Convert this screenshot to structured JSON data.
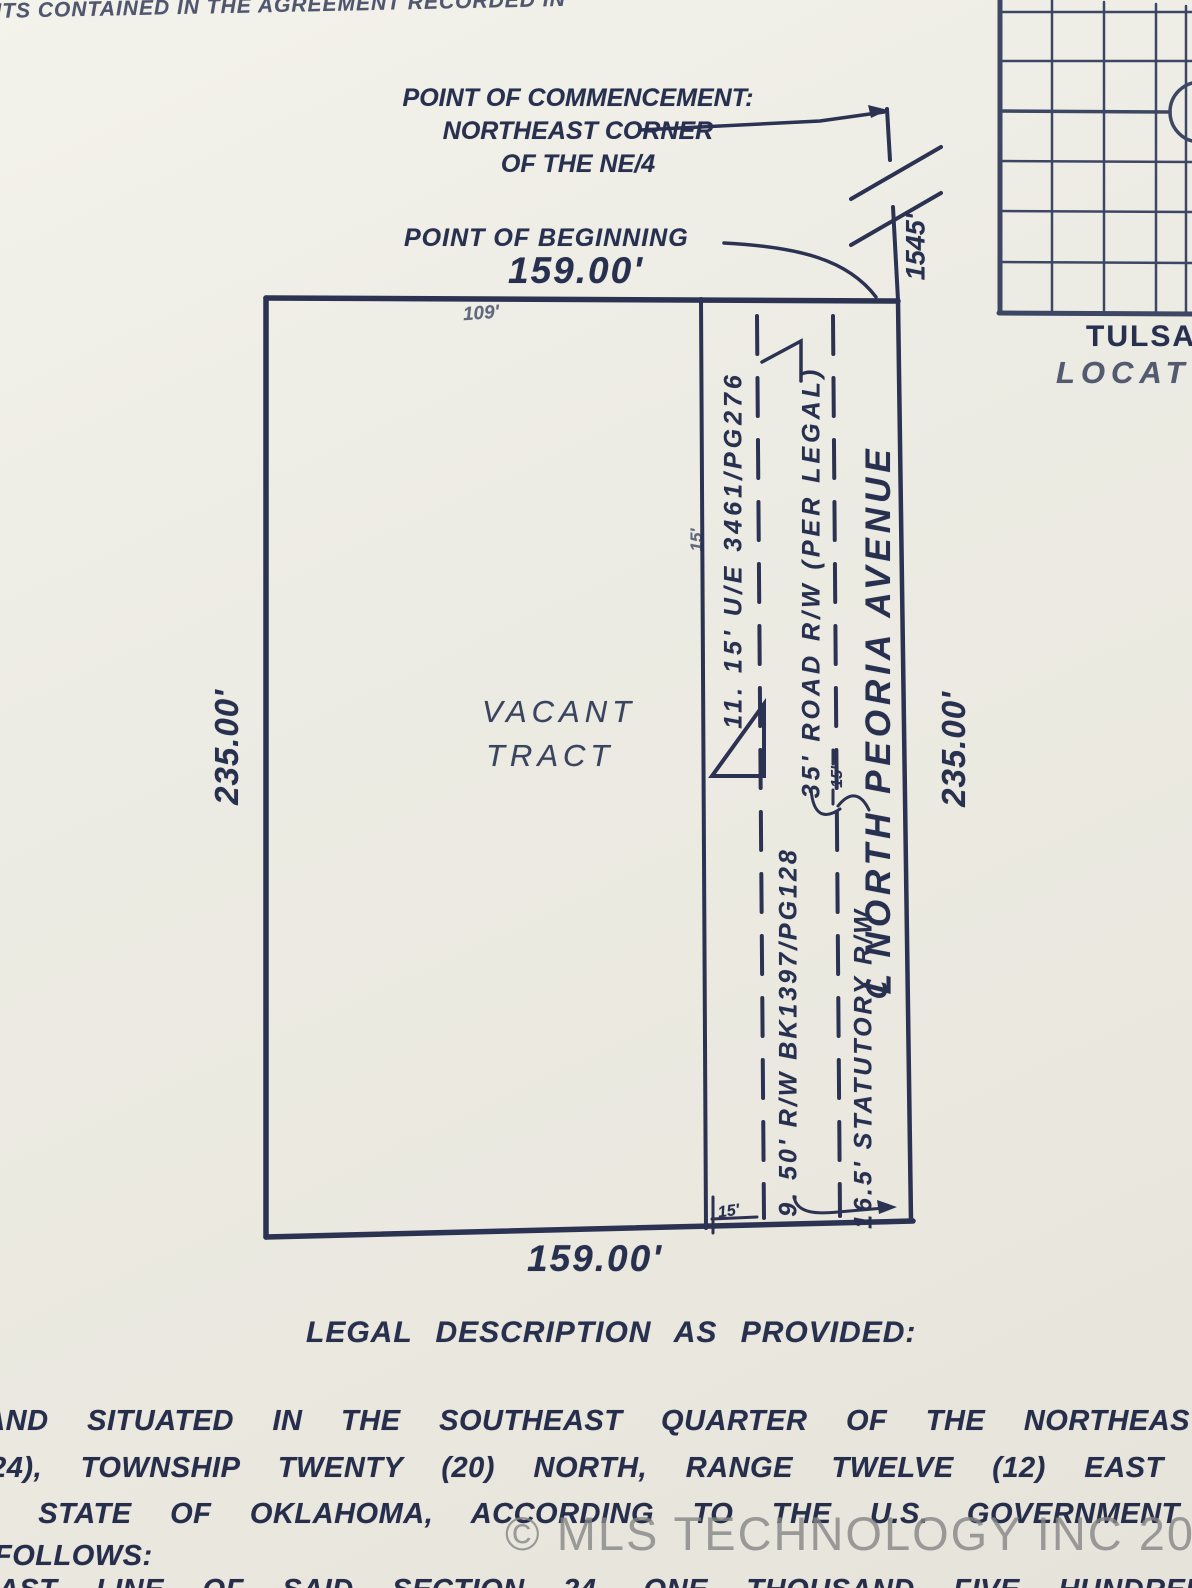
{
  "colors": {
    "paper": "#edece4",
    "ink": "#283050",
    "line": "#2b3252",
    "watermark": "#868686"
  },
  "top_note": "NTS CONTAINED IN THE AGREEMENT RECORDED IN",
  "survey": {
    "poc": [
      "POINT OF COMMENCEMENT:",
      "NORTHEAST CORNER",
      "OF THE NE/4"
    ],
    "pob": "POINT OF BEGINNING",
    "dim_top": "159.00'",
    "dim_bottom": "159.00'",
    "dim_left": "235.00'",
    "dim_right": "235.00'",
    "section_distance": "1545'",
    "top_offset": "109'",
    "tract": [
      "VACANT",
      "TRACT"
    ],
    "label_ue": "11. 15' U/E 3461/PG276",
    "label_ue_width": "15'",
    "label_road": "35' ROAD R/W (PER LEGAL)",
    "label_avenue": "℄ NORTH PEORIA AVENUE",
    "label_rw50": "9. 50' R/W BK1397/PG128",
    "label_statutory": "16.5' STATUTORY R/W",
    "label_15_mid": "15'",
    "label_15_bottom": "15'"
  },
  "legal": {
    "heading": "LEGAL DESCRIPTION AS PROVIDED:",
    "lines": [
      "LAND SITUATED IN THE SOUTHEAST QUARTER OF THE NORTHEAST QUARTER",
      "(24), TOWNSHIP TWENTY (20) NORTH, RANGE TWELVE (12) EAST OF TH",
      "Y, STATE OF OKLAHOMA, ACCORDING TO THE U.S. GOVERNMENT SURVEY",
      "FOLLOWS:",
      "EAST LINE OF SAID SECTION 24, ONE THOUSAND FIVE HUNDRED AND FOR"
    ]
  },
  "map": {
    "title": "TULSA",
    "subtitle": "LOCAT"
  },
  "watermark": "© MLS TECHNOLOGY INC 2026"
}
